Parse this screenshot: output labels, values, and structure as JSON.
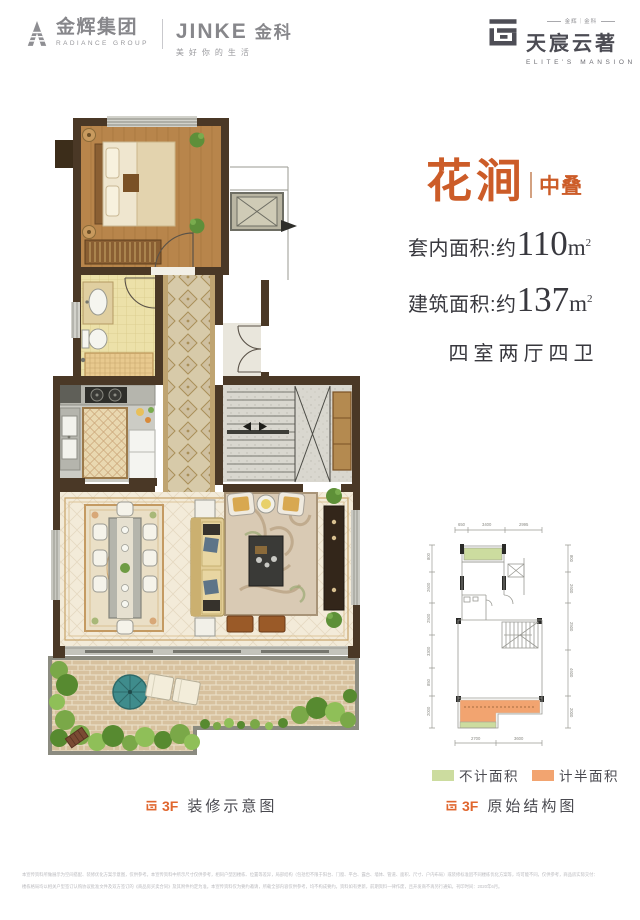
{
  "header": {
    "radiance_cn": "金辉集团",
    "radiance_en": "RADIANCE GROUP",
    "jinke_brand": "JINKE",
    "jinke_cn": "金科",
    "jinke_tagline": "美好你的生活",
    "estate_top": "金辉｜金科",
    "estate_cn": "天宸云著",
    "estate_en": "ELITE'S MANSION"
  },
  "unit": {
    "name": "花涧",
    "tag": "中叠",
    "areas": [
      {
        "label": "套内面积:约",
        "value": "110",
        "unit": "m",
        "sup": "2"
      },
      {
        "label": "建筑面积:约",
        "value": "137",
        "unit": "m",
        "sup": "2"
      }
    ],
    "rooms": "四室两厅四卫"
  },
  "captions": {
    "left_floor": "3F",
    "left_text": "装修示意图",
    "right_floor": "3F",
    "right_text": "原始结构图"
  },
  "legend": [
    {
      "label": "不计面积",
      "color": "#ccdc9f"
    },
    {
      "label": "计半面积",
      "color": "#f2a470"
    }
  ],
  "schematic_dims": {
    "top": [
      "650",
      "3400",
      "2995"
    ],
    "left": [
      "800",
      "2600",
      "2500",
      "3300",
      "850",
      "2000"
    ],
    "right": [
      "800",
      "2600",
      "2500",
      "4600",
      "2000"
    ],
    "bottom": [
      "2700",
      "3600"
    ]
  },
  "colors": {
    "accent_orange": "#cc5c28",
    "legend_green": "#ccdc9f",
    "legend_orange": "#f2a470"
  },
  "disclaimer": {
    "line1": "本宣传资料所做展示为空间搭配、装修优化方案示意图，仅供参考。本宣传资料中所示尺寸仅供参考，相同户型因楼栋、位置等差异，局部结构（包括但不限于阳台、门窗、平台、露台、墙体、管道、面积、尺寸、户内布局）或装修标准因不同楼栋优化方案等，均可能不同，仅供参考，商品房实际交付：",
    "line2": "楼栋格局均以相关户型签订认购协议批准文件及双方签订的《商品房买卖合同》及其附件约定为准。本宣传资料仅为要约邀请，所载全部内容仅供参考，均不构成要约。资料如有更新，前期资料一律作废，且开发商不再另行通知。刊印时间：2020年6月。"
  }
}
